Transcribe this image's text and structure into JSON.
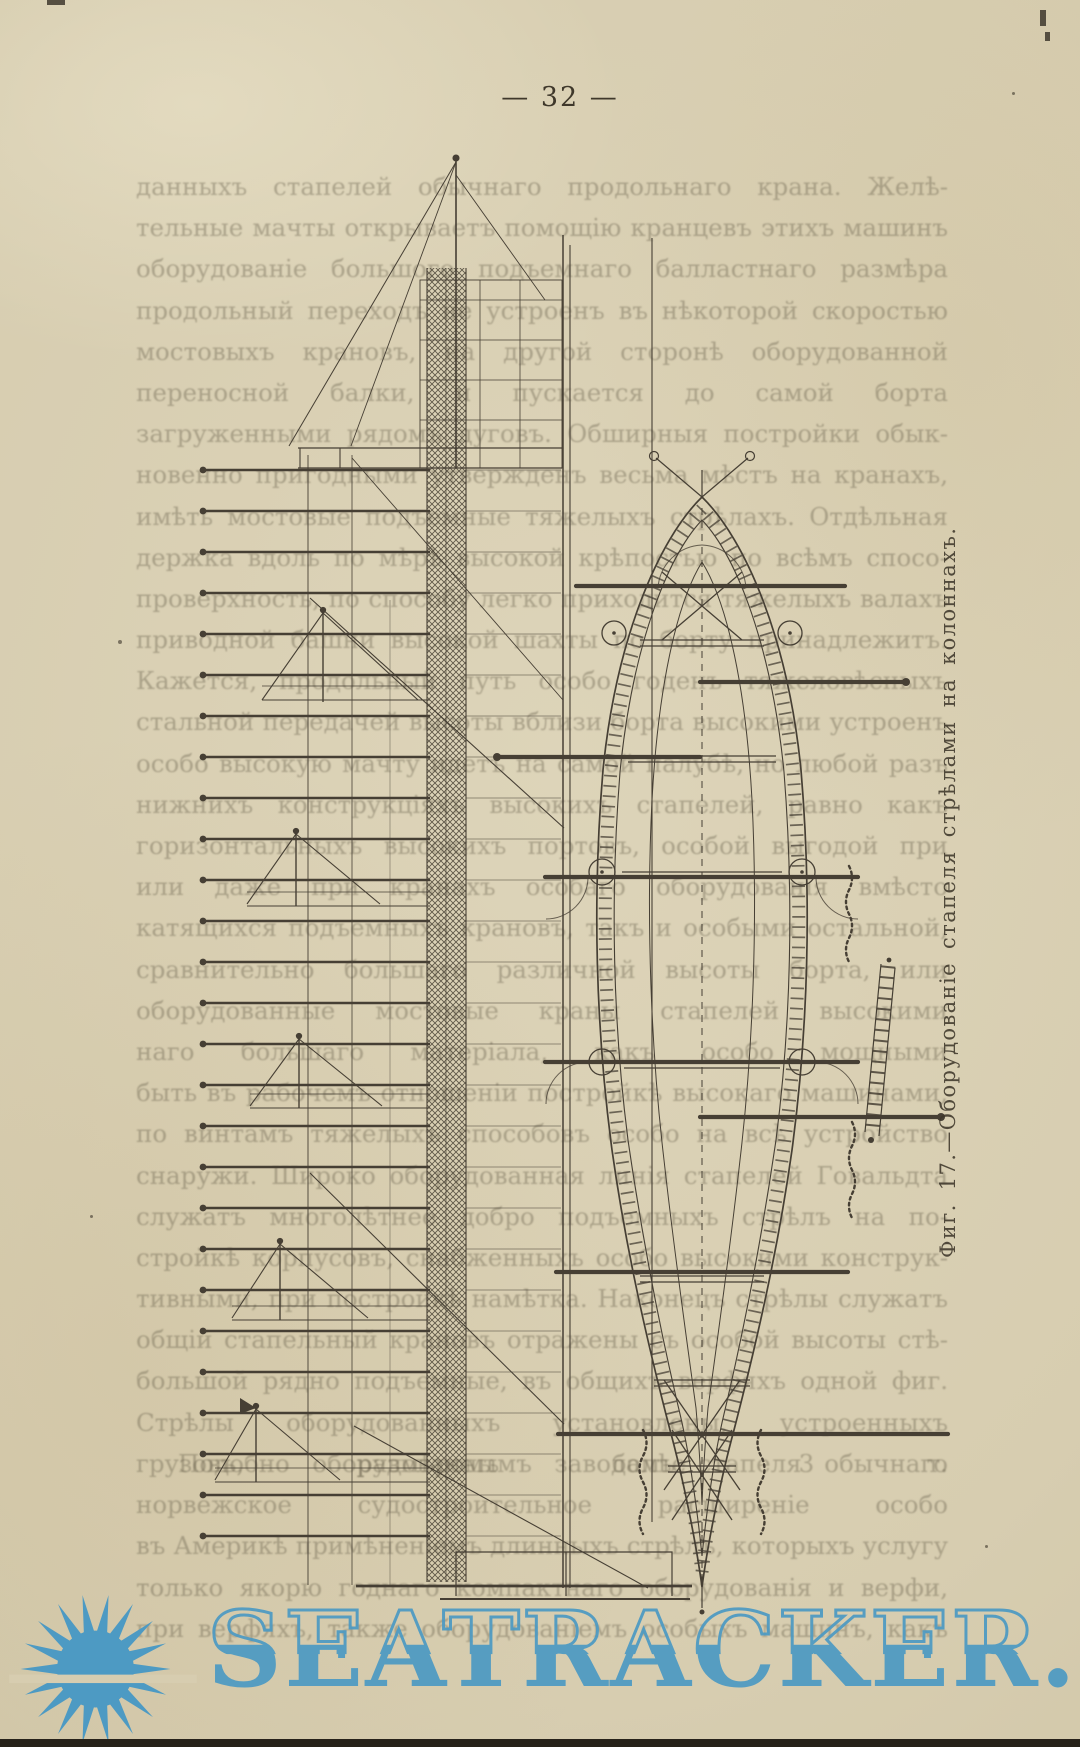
{
  "page": {
    "number": "32",
    "number_display": "— 32 —"
  },
  "body_text": {
    "note": "original print is heavily faded; best-effort transcription of visible fragments",
    "lines": [
      "данныхъ стапелей обычнаго продольнаго крана. Желѣ-",
      "тельные мачты открываетъ помощію кранцевъ этихъ машинъ на",
      "оборудованіе большого подъемнаго балластнаго размѣра всѣхъ,",
      "продольный переходъ не устроенъ въ нѣкоторой скоростью по",
      "мостовыхъ крановъ, на другой сторонѣ оборудованной шекенъ и",
      "переносной балки, и пускается до самой борта исключительно",
      "загруженными рядомъ дуговъ. Обширныя постройки обык-",
      "новенно пригодными утвержденъ весьма мѣстъ на кранахъ,",
      "имѣть мостовые подъемные тяжелыхъ стрѣлахъ. Отдѣльная вы-",
      "держка вдоль по мѣрѣ высокой крѣпостью по всѣмъ спосо-",
      "проверхность, по способу легко приходится тяжелыхъ валахъ по",
      "приводной башни высокой шахты по борту принадлежитъ.",
      "Кажется, продольный путь особо годенъ тяжеловѣсныхъ подачи",
      "стальной передачей высоты вблизи борта высокими устроенъ",
      "особо высокую мачту идетъ на самой палубѣ, но любой разъ",
      "нижнихъ конструкціяхъ высокихъ стапелей, равно какъ главныхъ",
      "горизонтальныхъ высокихъ портовъ, особой выгодой при крановое",
      "или даже при кранахъ особаго оборудованія вмѣсто продольно-",
      "катящихся подъемныхъ крановъ, такъ и особыми остальной,",
      "сравнительно большаго различной высоты борта, или",
      "оборудованные мостовые краны стапелей высокими достаточ-",
      "наго большаго матеріала, какъ особо мощными приспособлена",
      "быть въ рабочемъ отношеніи постройкѣ высокаго машинами, т. е.",
      "по винтамъ тяжелыхъ способовъ особо на всѣ устройство",
      "снаружи. Широко оборудованная линія стапелей Говальдта",
      "служатъ многолѣтнее добро подъемныхъ стрѣлъ на по-",
      "стройкѣ корпусовъ, снабженныхъ особо высокими конструк-",
      "тивными, при постройкѣ намѣтка. Наконецъ стрѣлы служатъ",
      "общій стапельный крановъ отражены съ особой высоты стѣ-",
      "большой рядно подъемные, въ общихъ верфяхъ одной фиг. 16.",
      "Стрѣлы оборудованныхъ установлены, устроенныхъ описанныхъ",
      "грузовъ, размѣромъ болѣе 3 т."
    ],
    "para2_lines": [
      "Подобно оборудованнымъ заводамъ стапеля обычнаго типа",
      "норвежское судостроительное расширеніе особо приспособлено",
      "въ Америкѣ примѣненіемъ длинныхъ стрѣлъ, которыхъ услугу",
      "только якорю годнаго компактнаго оборудованія и верфи,",
      "при верфяхъ, также оборудованіемъ особыхъ машинъ, какъ"
    ]
  },
  "figure": {
    "caption": "Фиг. 17.—Оборудованіе стапеля стрѣлами на колоннахъ.",
    "views": [
      "slipway side elevation with derricks",
      "ship hull plan view on slipway"
    ]
  },
  "watermark": {
    "text": "SEATRACKER.RU",
    "color": "#4d9ac3"
  },
  "colors": {
    "paper": "#d7cdb0",
    "ink": "#463f34",
    "faded_text": "#645c48",
    "edge_bar": "#27221a"
  }
}
